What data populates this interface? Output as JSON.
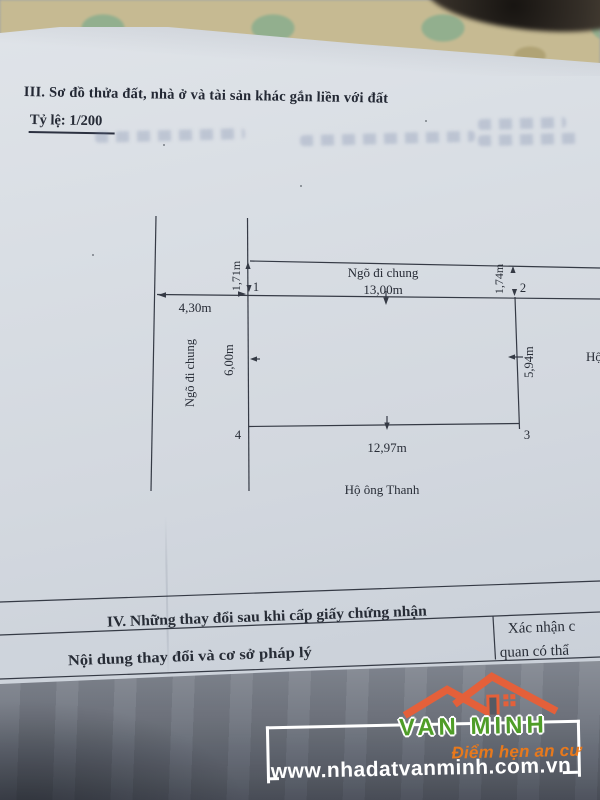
{
  "page": {
    "section3": {
      "title": "III. Sơ đồ thửa đất, nhà ở và tài sản khác gắn liền với đất",
      "scale_label": "Tỷ lệ: 1/200"
    },
    "diagram": {
      "road_top_label": "Ngõ đi chung",
      "road_left_label": "Ngõ đi chung",
      "edge_top": "13,00m",
      "edge_bottom": "12,97m",
      "edge_left": "6,00m",
      "edge_right": "5,94m",
      "offset_left": "1,71m",
      "offset_right": "1,74m",
      "road_width": "4,30m",
      "neighbor_bottom": "Hộ ông Thanh",
      "neighbor_right_partial": "Hộ",
      "corner_1": "1",
      "corner_2": "2",
      "corner_3": "3",
      "corner_4": "4"
    },
    "section4": {
      "title": "IV. Những thay đổi sau khi cấp giấy chứng nhận",
      "col_content": "Nội dung thay đổi và cơ sở pháp lý",
      "col_confirm_line1": "Xác nhận c",
      "col_confirm_line2": "quan có thẩ"
    },
    "watermark": {
      "brand": "VAN MINH",
      "tagline": "Điểm hẹn an cư",
      "website": "www.nhadatvanminh.com.vn",
      "colors": {
        "roof_orange": "#e4603a",
        "brand_green": "#4f9d28",
        "tagline_orange": "#e8791c",
        "website_white": "#ffffff"
      }
    }
  }
}
